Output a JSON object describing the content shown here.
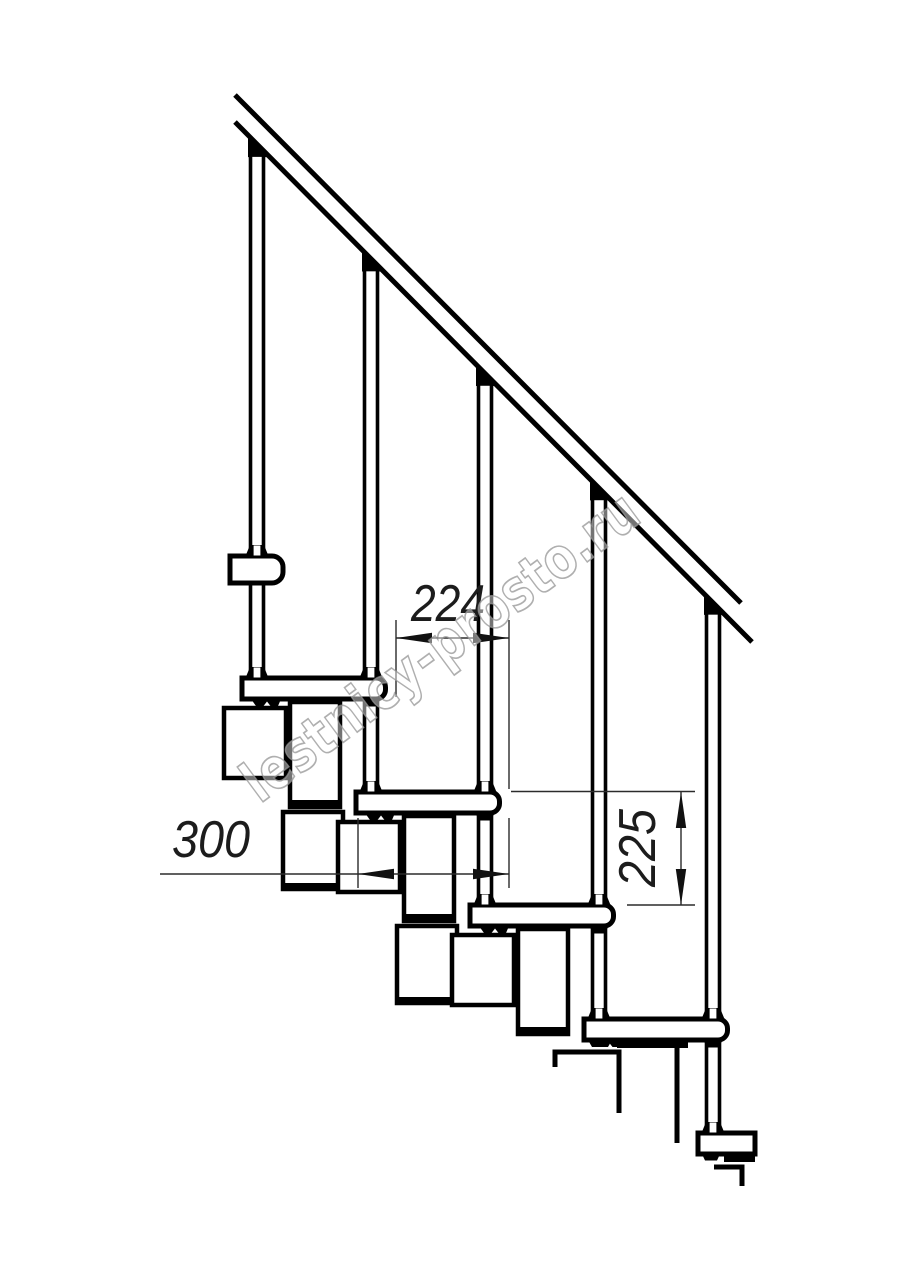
{
  "meta": {
    "type": "technical-drawing",
    "subject": "Side view of a modular staircase section with handrail and balusters"
  },
  "colors": {
    "background": "#ffffff",
    "line": "#000000",
    "dimension_line": "#2b2b2b",
    "dimension_text": "#1c1c1c",
    "watermark": "#949494"
  },
  "dimensions": {
    "step_run": {
      "label": "224",
      "orientation": "horizontal"
    },
    "tread_depth": {
      "label": "300",
      "orientation": "horizontal"
    },
    "riser_height": {
      "label": "225",
      "orientation": "vertical"
    }
  },
  "watermark": {
    "text": "lestnicy-prosto.ru"
  },
  "structure": {
    "tread_count": 5,
    "baluster_count": 5,
    "module_count": 4,
    "has_handrail": true,
    "has_perpendicular_handrail_end": true
  }
}
